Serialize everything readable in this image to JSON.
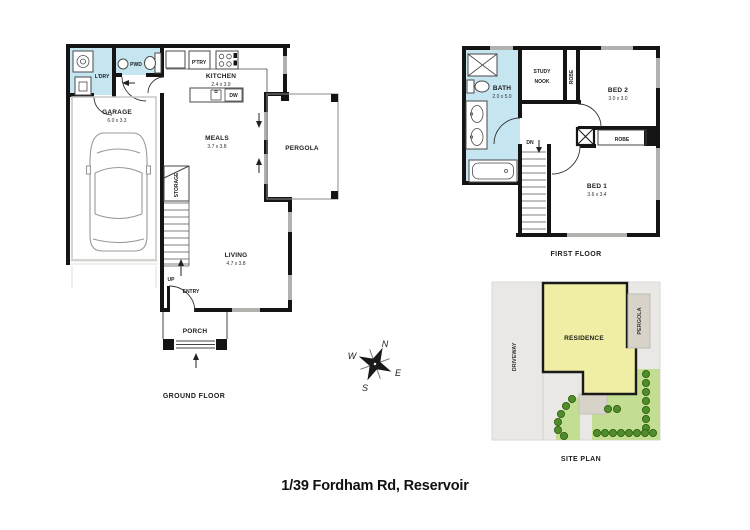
{
  "title": "1/39 Fordham Rd, Reservoir",
  "ground_floor": {
    "label": "GROUND FLOOR",
    "laundry": "L'DRY",
    "powder": "PWD",
    "pantry": "P'TRY",
    "kitchen": "KITCHEN",
    "kitchen_dims": "2.4 x 3.9",
    "garage": "GARAGE",
    "garage_dims": "6.0 x 3.3",
    "meals": "MEALS",
    "meals_dims": "3.7 x 3.8",
    "living": "LIVING",
    "living_dims": "4.7 x 3.8",
    "storage": "STORAGE",
    "pergola": "PERGOLA",
    "porch": "PORCH",
    "up": "UP",
    "entry": "ENTRY",
    "dishwasher": "DW"
  },
  "first_floor": {
    "label": "FIRST FLOOR",
    "bath": "BATH",
    "bath_dims": "2.0 x 5.0",
    "study_line1": "STUDY",
    "study_line2": "NOOK",
    "robe_bed2": "ROBE",
    "robe_bed1": "ROBE",
    "bed2": "BED 2",
    "bed2_dims": "3.0 x 3.0",
    "bed1": "BED 1",
    "bed1_dims": "3.6 x 3.4",
    "down": "DN"
  },
  "site_plan": {
    "label": "SITE PLAN",
    "driveway": "DRIVEWAY",
    "residence": "RESIDENCE",
    "pergola": "PERGOLA"
  },
  "compass": {
    "north": "N",
    "east": "E",
    "south": "S",
    "west": "W"
  },
  "colors": {
    "wall": "#141414",
    "window": "#b3b1ad",
    "wet_area": "#c5e5f1",
    "residence_fill": "#f0eda4",
    "lawn": "#c3dd92",
    "bush": "#4e8d29",
    "bush_stroke": "#2d5c12",
    "site_bg": "#e9e8e4",
    "pad": "#d7d3c8"
  }
}
